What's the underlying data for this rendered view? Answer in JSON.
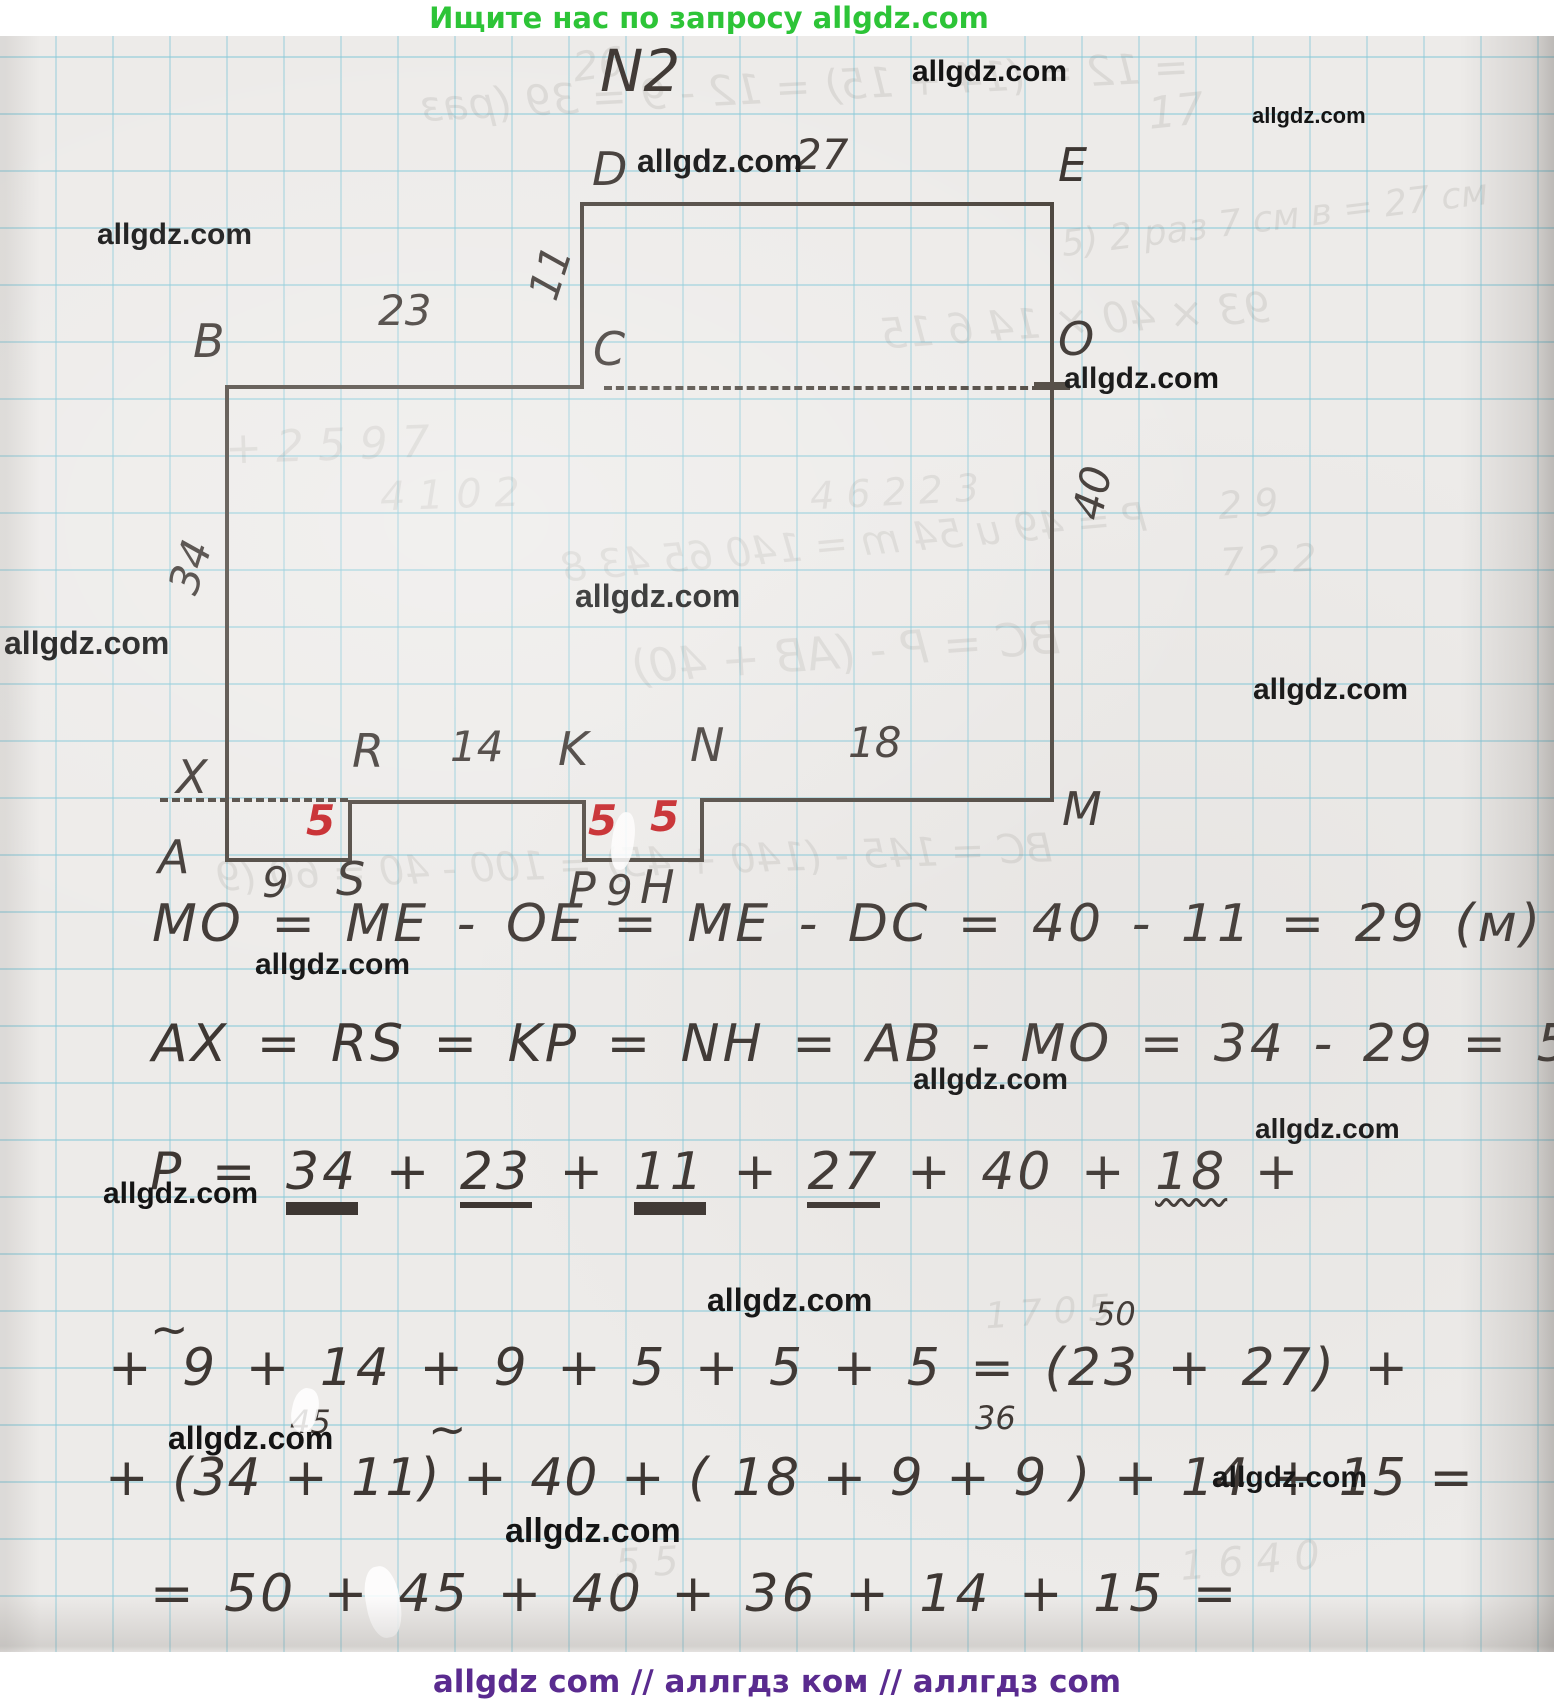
{
  "banner": {
    "text": "Ищите нас по запросу allgdz.com"
  },
  "title": "N2",
  "watermark_text": "allgdz.com",
  "colors": {
    "banner_green": "#2dc437",
    "footer_purple": "#5a2b8f",
    "ink": "#3e3733",
    "red": "#c52125",
    "grid_blue": "#86c8d8"
  },
  "figure": {
    "vertices": {
      "A": "A",
      "B": "B",
      "C": "C",
      "D": "D",
      "E": "E",
      "O": "O",
      "M": "M",
      "N": "N",
      "K": "K",
      "R": "R",
      "S": "S",
      "P": "P",
      "H": "H",
      "X": "X"
    },
    "sides": {
      "DE": "27",
      "DC": "11",
      "BC": "23",
      "EM": "40",
      "AB": "34",
      "RK": "14",
      "NM": "18",
      "AS": "9",
      "PH": "9"
    },
    "red": {
      "RS": "5",
      "KP": "5",
      "NH": "5"
    }
  },
  "solution": {
    "line1": "MO = ME - OE = ME - DC = 40 - 11 = 29 (м)",
    "line2": "AX = RS = KP = NH = AB - MO = 34 - 29 = 5 (м)",
    "line3": {
      "lhs": "P",
      "eq": "=",
      "plus": "+",
      "terms": [
        "34",
        "23",
        "11",
        "27",
        "40",
        "18"
      ],
      "underlines": [
        "double",
        "single",
        "double",
        "single",
        "none",
        "wavy"
      ]
    },
    "line4": "+ 9 + 14 + 9 + 5 + 5 + 5 = (23 + 27) +",
    "line5": "+ (34 + 11) + 40 + ( 18 + 9 + 9 ) + 14 + 15 =",
    "line6": "= 50 + 45 + 40 + 36 + 14 + 15 =",
    "sup_50": "50",
    "sup_45": "45",
    "sup_36": "36",
    "tilde": "~"
  },
  "footer": {
    "text": "allgdz com  //  аллгдз ком  //  аллгдз com"
  },
  "bleedthrough": [
    "26",
    "17",
    "= 12 = (14 + 15) = 12 - 9 = 39 (раз",
    "5) 2 раз 7 см в = 27 см",
    "93 × 40 × 14 6 15",
    "+ 2 5 9 7",
    "4 1 0 2",
    "4 6 2   2 3",
    "2 9",
    "P = 49 u 54 m = 140 65 43 8",
    "7 2 2",
    "BC = P - (AB + 40)",
    "BC = 145 - (140 + 45) = 100 - 40 = 60 (9",
    "1 6 4 0",
    "5 5",
    "1 7 0 5"
  ]
}
